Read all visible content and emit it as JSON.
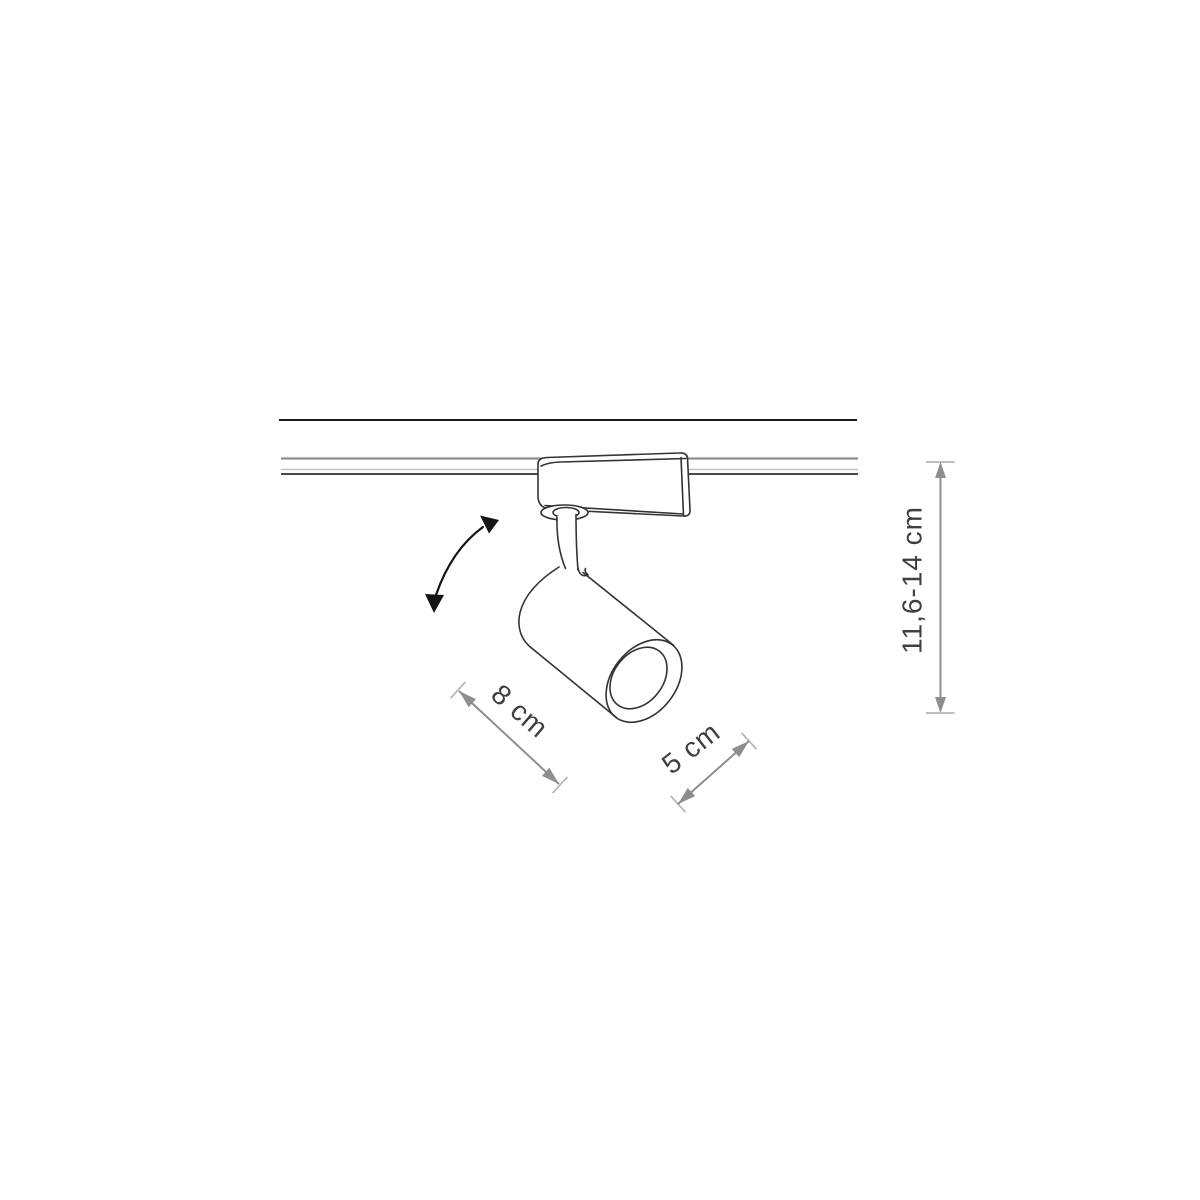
{
  "dimension_labels": {
    "spot_length": "8 cm",
    "spot_diameter": "5 cm",
    "height_range": "11,6-14 cm"
  },
  "icons": {
    "rotation_arrow": "rotation-arrow-icon",
    "dimension_arrows": "double-arrow-dimension-lines"
  },
  "colors": {
    "background": "#ffffff",
    "outline": "#333333",
    "ceiling_line": "#1a1a1a",
    "rail_gray": "#8f8f8f",
    "rail_light": "#c2c2c2",
    "rail_dark": "#303030",
    "dimension_line": "#8e8e8e",
    "dimension_tick": "#b5b5b5",
    "label_text": "#3f3f3f",
    "rotation_arrow": "#141414"
  }
}
